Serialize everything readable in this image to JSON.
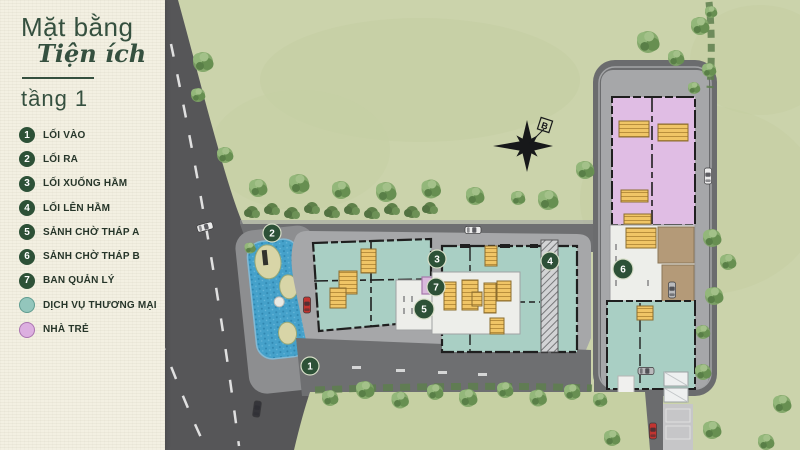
{
  "panel": {
    "title_line1": "Mặt bằng",
    "title_line2": "Tiện ích",
    "title_line3": "tầng 1"
  },
  "legend": {
    "numbered_items": [
      {
        "num": "1",
        "label": "LỐI VÀO"
      },
      {
        "num": "2",
        "label": "LỐI RA"
      },
      {
        "num": "3",
        "label": "LỐI XUỐNG HẦM"
      },
      {
        "num": "4",
        "label": "LỐI LÊN HẦM"
      },
      {
        "num": "5",
        "label": "SẢNH CHỜ THÁP A"
      },
      {
        "num": "6",
        "label": "SẢNH CHỜ THÁP B"
      },
      {
        "num": "7",
        "label": "BAN QUẢN LÝ"
      }
    ],
    "zone_items": [
      {
        "label": "DỊCH VỤ THƯƠNG MẠI",
        "color": "#93c6bc"
      },
      {
        "label": "NHÀ TRẺ",
        "color": "#dcafe0"
      }
    ]
  },
  "plan": {
    "compass_label": "B",
    "markers": [
      "1",
      "2",
      "3",
      "4",
      "5",
      "6",
      "7"
    ]
  },
  "colors": {
    "marker_green": "#2d5137",
    "commercial_teal": "#a9cfc4",
    "kindergarten_pink": "#e0bde4",
    "stair_yellow": "#f0c566",
    "pond_blue": "#45a1ca",
    "grass_green": "#cbd3ab",
    "road_gray": "#5a5a5c",
    "panel_cream": "#f3f0e2",
    "title_green": "#35503f"
  }
}
